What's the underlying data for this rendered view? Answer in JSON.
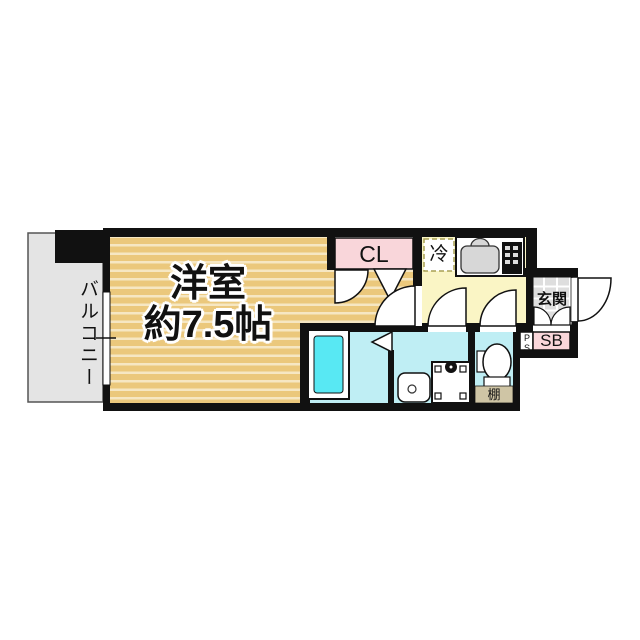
{
  "plan": {
    "balcony_label": "バルコニー",
    "room_label_line1": "洋室",
    "room_label_line2": "約7.5帖",
    "closet_label": "CL",
    "fridge_label": "冷",
    "entrance_label": "玄関",
    "shoebox_label": "SB",
    "pipe_space_label": "PS",
    "shelf_label": "棚"
  },
  "colors": {
    "wall": "#111111",
    "room_floor": "#ebc87c",
    "room_stripe": "#f6e7c3",
    "kitchen_floor": "#faf5c5",
    "closet_fill": "#f9d6da",
    "shoebox_fill": "#f9d6da",
    "bath_floor": "#bfeef4",
    "bathtub_fill": "#58e8f3",
    "balcony_fill": "#e4e4e4",
    "entrance_tile": "#dedede",
    "shelf_fill": "#cfc5a5",
    "sink_fill": "#d7d7d7",
    "stove_fill": "#111111",
    "fixture_fill": "#ffffff"
  }
}
